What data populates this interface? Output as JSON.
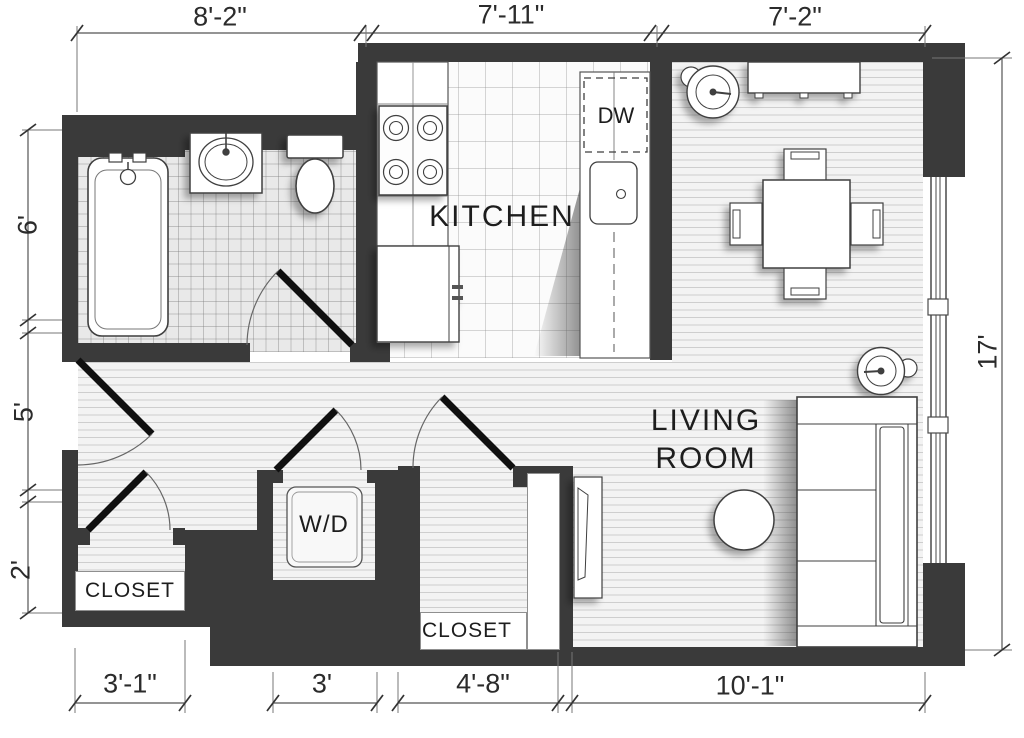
{
  "rooms": {
    "kitchen": "KITCHEN",
    "living_line1": "LIVING",
    "living_line2": "ROOM",
    "closet_left": "CLOSET",
    "closet_center": "CLOSET",
    "washer_dryer": "W/D",
    "dishwasher": "DW"
  },
  "dimensions": {
    "top": [
      "8'-2\"",
      "7'-11\"",
      "7'-2\""
    ],
    "left": [
      "6'",
      "5'",
      "2'"
    ],
    "right": [
      "17'"
    ],
    "bottom": [
      "3'-1\"",
      "3'",
      "4'-8\"",
      "10'-1\""
    ]
  },
  "colors": {
    "wall": "#3a3a3a",
    "outline": "#404040",
    "dim_line": "#555555",
    "text": "#1d1d1d"
  }
}
